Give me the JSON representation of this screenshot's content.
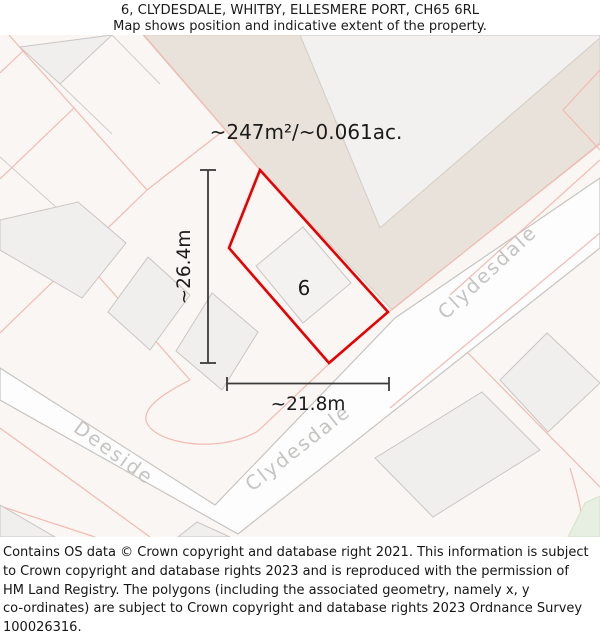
{
  "header": {
    "title": "6, CLYDESDALE, WHITBY, ELLESMERE PORT, CH65 6RL",
    "subtitle": "Map shows position and indicative extent of the property."
  },
  "map": {
    "area_label": "~247m²/~0.061ac.",
    "height_label": "~26.4m",
    "width_label": "~21.8m",
    "plot_number": "6",
    "streets": {
      "clydesdale_upper": "Clydesdale",
      "clydesdale_lower": "Clydesdale",
      "deeside": "Deeside"
    },
    "colors": {
      "property_outline": "#e90000",
      "map_background": "#faf6f4",
      "road_fill": "#fdfdfd",
      "road_edge": "#c7c4c1",
      "beige_road": "#e9e2da",
      "building_fill": "#f0efed",
      "parcel_line_pink": "#f5b9b0",
      "street_label": "#c6c4c2",
      "dimension_line": "#3b3b3b",
      "green_area": "#e7efe2"
    }
  },
  "footer": {
    "lines": [
      "Contains OS data © Crown copyright and database right 2021. This information is subject",
      "to Crown copyright and database rights 2023 and is reproduced with the permission of",
      "HM Land Registry. The polygons (including the associated geometry, namely x, y",
      "co-ordinates) are subject to Crown copyright and database rights 2023 Ordnance Survey",
      "100026316."
    ]
  }
}
